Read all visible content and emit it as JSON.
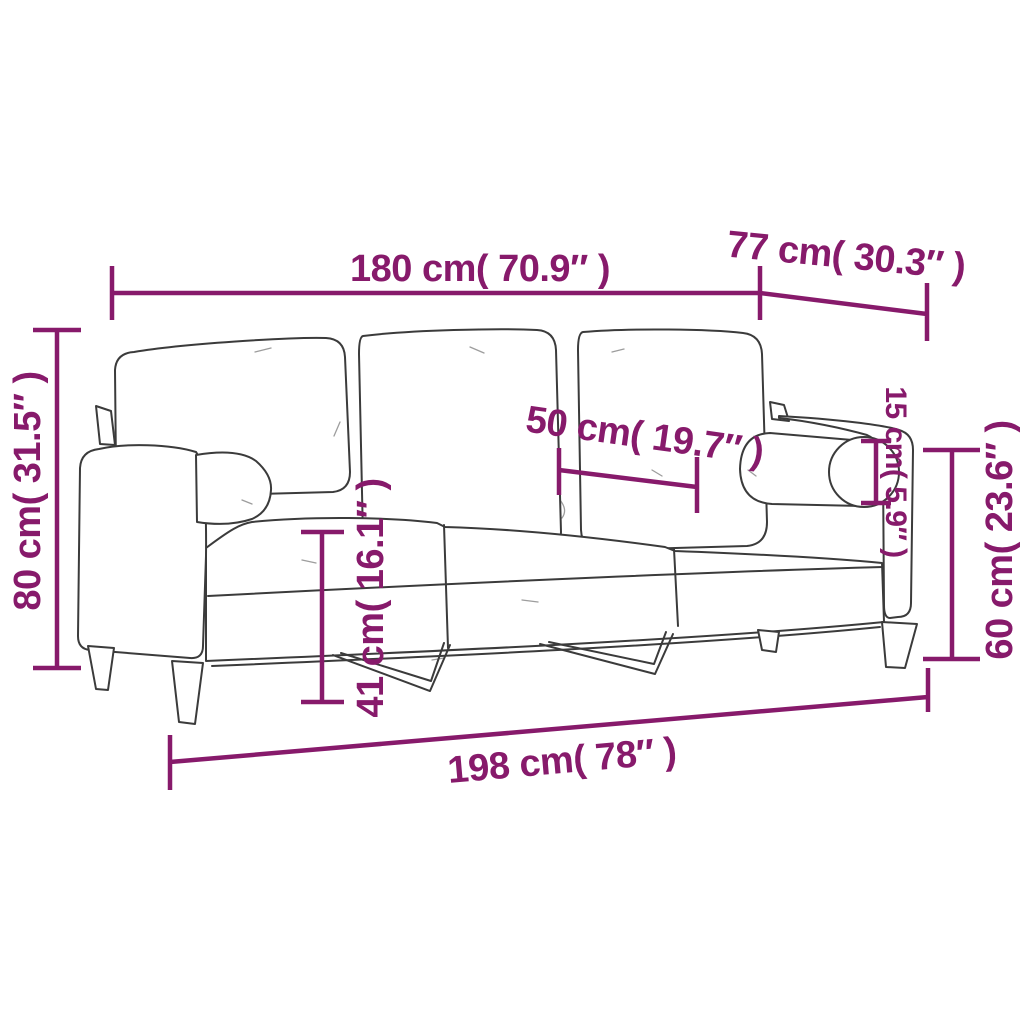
{
  "diagram": {
    "type": "product-dimension-diagram",
    "subject": "3-seater sofa with throw pillows, line drawing with measurements",
    "background": "#ffffff",
    "colors": {
      "dimension_accent": "#871a6b",
      "sofa_outline": "#3b3b3b"
    },
    "dimensions": [
      {
        "id": "overall-width",
        "label": "180 cm( 70.9″ )"
      },
      {
        "id": "overall-depth",
        "label": "77 cm( 30.3″ )"
      },
      {
        "id": "seat-depth",
        "label": "50 cm( 19.7″ )"
      },
      {
        "id": "pillow-diameter",
        "label": "15 cm( 5.9″ )"
      },
      {
        "id": "overall-height",
        "label": "80 cm( 31.5″ )"
      },
      {
        "id": "arm-height",
        "label": "60 cm( 23.6″ )"
      },
      {
        "id": "seat-height",
        "label": "41 cm( 16.1″ )"
      },
      {
        "id": "overall-length",
        "label": "198 cm( 78″ )"
      }
    ]
  }
}
